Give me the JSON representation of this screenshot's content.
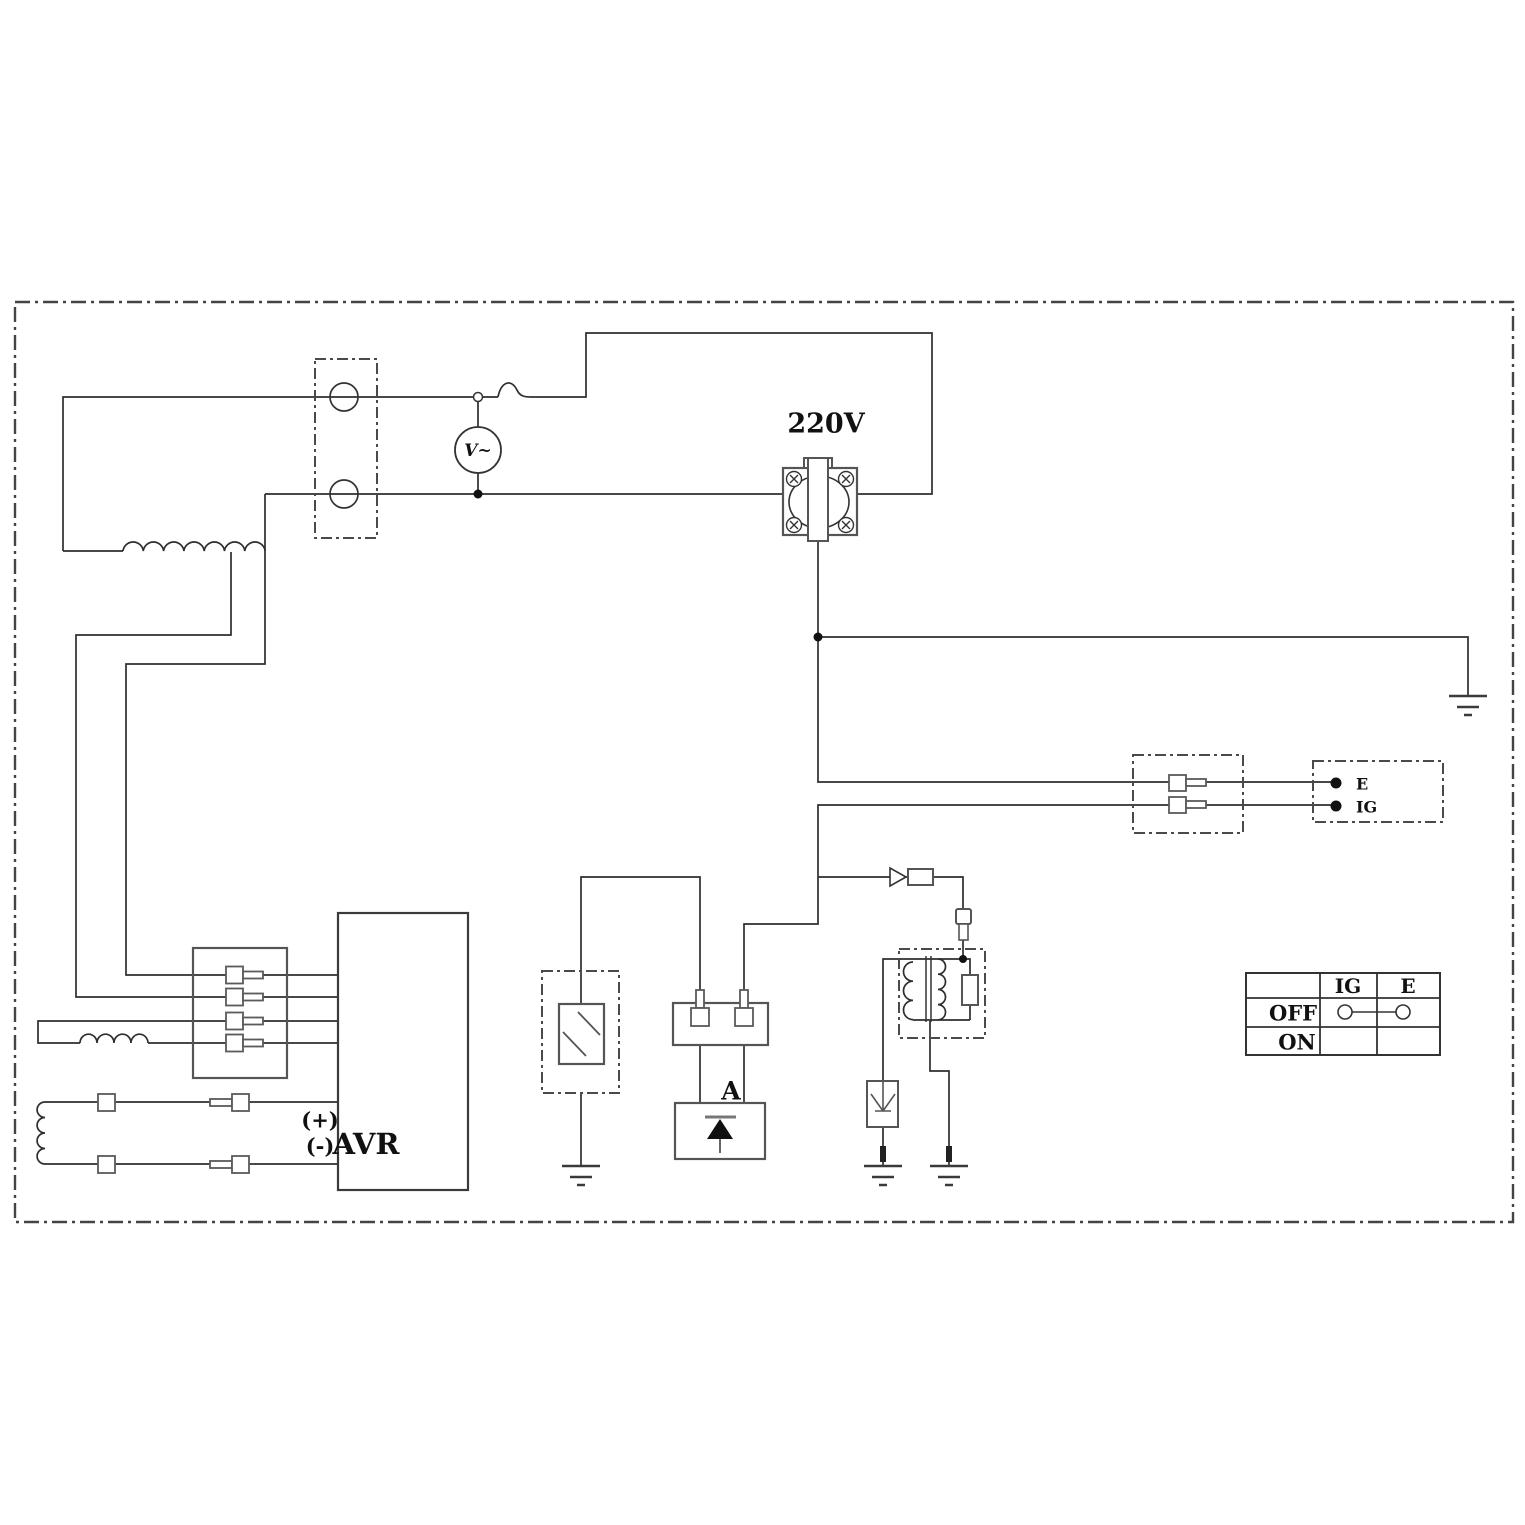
{
  "labels": {
    "outlet_voltage": "220V",
    "voltmeter": "V~",
    "avr": "AVR",
    "avr_plus": "(+)",
    "avr_minus": "(-)",
    "diode_unit": "A",
    "stop_switch_e": "E",
    "stop_switch_ig": "IG"
  },
  "switch_table": {
    "header_ig": "IG",
    "header_e": "E",
    "row_off": "OFF",
    "row_on": "ON"
  },
  "colors": {
    "wire": "#2e2e2e",
    "component": "#555555",
    "background": "#ffffff"
  }
}
